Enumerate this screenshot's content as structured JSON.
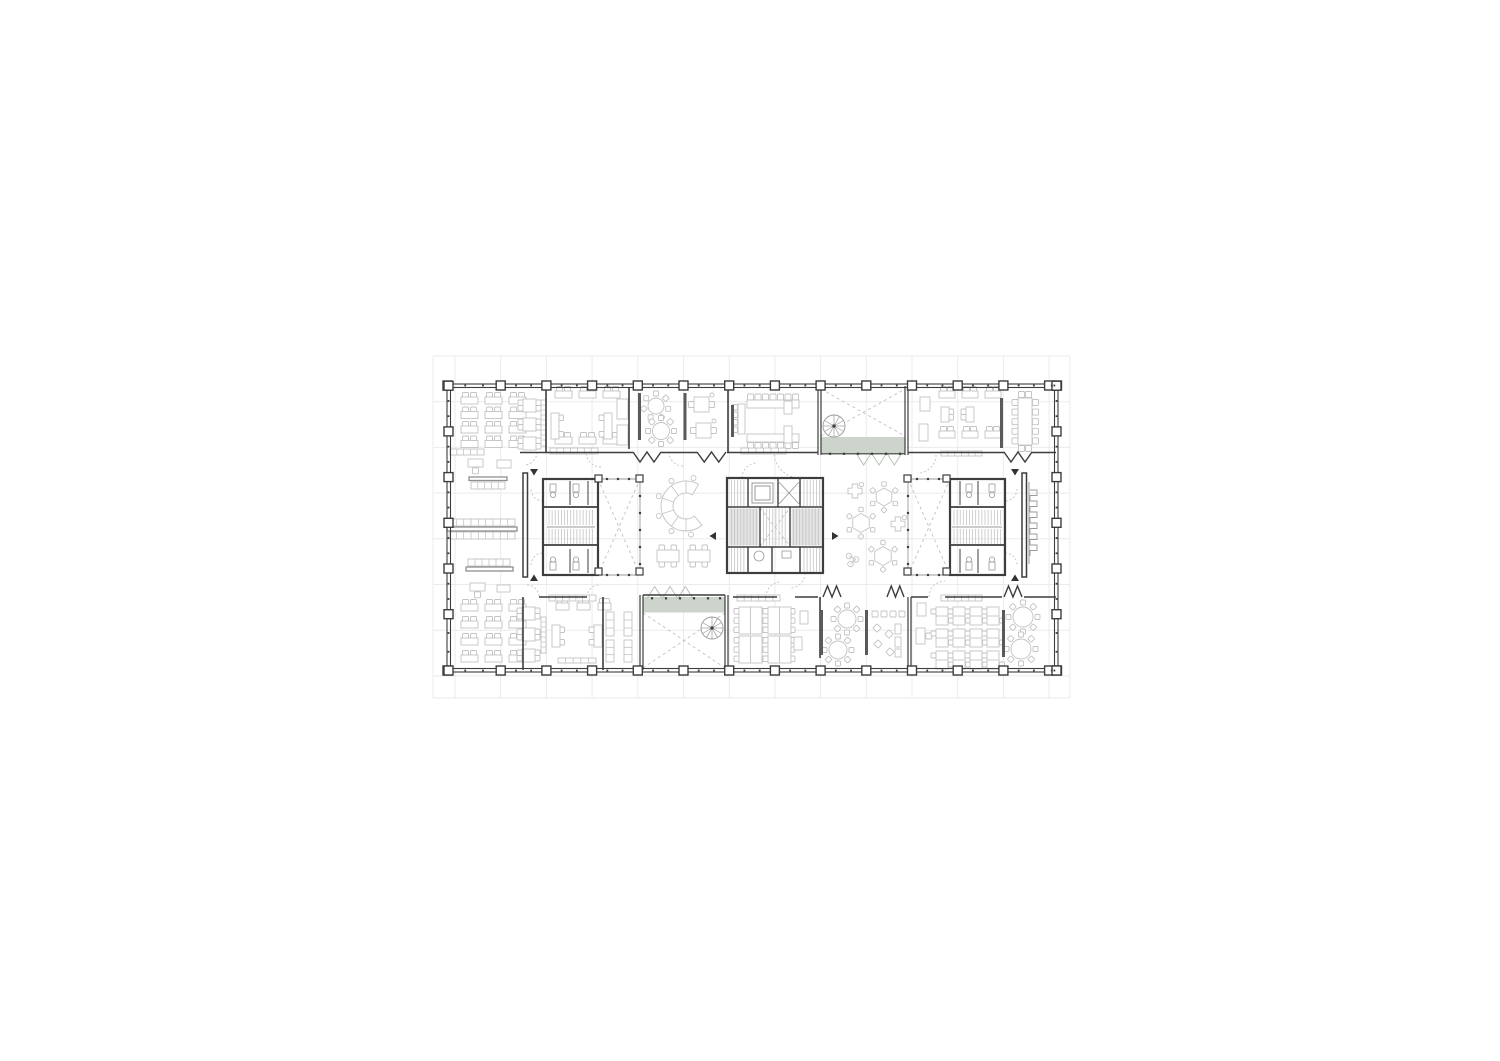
{
  "palette": {
    "bg": "#ffffff",
    "grid": "#ebebeb",
    "wall": "#3d3d3d",
    "wall_light": "#9a9a9a",
    "furniture": "#c3c3c3",
    "furniture_dark": "#8f8f8f",
    "dash": "#c2c2c2",
    "green": "#cdd4cb",
    "green_line": "#b6c2b5",
    "stair_fill": "#e4e4e4",
    "hatch": "#bcbcbc"
  },
  "canvas": {
    "w": 1500,
    "h": 1061
  },
  "grid": {
    "x0": 433,
    "y0": 356,
    "x1": 1070,
    "y1": 698,
    "vxs": [
      455,
      500.7,
      546.4,
      592.1,
      637.8,
      683.5,
      729.2,
      774.9,
      820.6,
      866.3,
      912,
      957.7,
      1003.4,
      1049.1
    ],
    "hys": [
      356,
      401.7,
      447.4,
      493.1,
      538.8,
      584.5,
      630.2,
      675.9
    ]
  },
  "building": {
    "x": 447,
    "y": 384,
    "w": 611,
    "h": 288
  },
  "columns": {
    "size": 9,
    "tick": 1.8,
    "top_xs": [
      447.5,
      500.7,
      546.4,
      592.1,
      637.8,
      683.5,
      729.2,
      774.9,
      820.6,
      866.3,
      912,
      957.7,
      1003.4,
      1049.1,
      1057
    ],
    "top_y": 385.5,
    "bottom_y": 670.5,
    "side_ys": [
      385.7,
      431.4,
      477.1,
      522.8,
      568.5,
      614.2,
      670.5
    ],
    "left_x": 448.5,
    "right_x": 1056.5
  },
  "walls": [
    [
      546,
      388,
      546,
      452,
      1.6
    ],
    [
      629,
      388,
      629,
      449,
      1.6
    ],
    [
      728,
      388,
      728,
      452,
      1.6
    ],
    [
      818,
      386,
      818,
      455,
      1.2
    ],
    [
      821,
      386,
      821,
      455,
      1.2
    ],
    [
      905,
      386,
      905,
      455,
      1.2
    ],
    [
      908,
      386,
      908,
      455,
      1.2
    ],
    [
      520,
      452.5,
      633,
      452.5,
      1.6
    ],
    [
      661,
      452.5,
      697,
      452.5,
      1.6
    ],
    [
      727,
      452.5,
      818,
      452.5,
      1.6
    ],
    [
      821,
      453.8,
      905,
      453.8,
      1.1
    ],
    [
      908,
      452.5,
      1004,
      452.5,
      1.6
    ],
    [
      1032,
      452.5,
      1056,
      452.5,
      1.6
    ],
    [
      543,
      507,
      598,
      507,
      1.8
    ],
    [
      543,
      545,
      598,
      545,
      1.8
    ],
    [
      570,
      481,
      570,
      505,
      1
    ],
    [
      570,
      549,
      570,
      573,
      1
    ],
    [
      588,
      481,
      588,
      505,
      1
    ],
    [
      588,
      549,
      588,
      573,
      1
    ],
    [
      727,
      507,
      823,
      507,
      1.6
    ],
    [
      727,
      547,
      823,
      547,
      1.6
    ],
    [
      748,
      478,
      748,
      507,
      1.4
    ],
    [
      778,
      478,
      778,
      507,
      1.4
    ],
    [
      800,
      478,
      800,
      507,
      1.4
    ],
    [
      748,
      547,
      748,
      573,
      1.4
    ],
    [
      772,
      547,
      772,
      573,
      1.4
    ],
    [
      800,
      547,
      800,
      573,
      1.4
    ],
    [
      760,
      507,
      760,
      547,
      1.4
    ],
    [
      790,
      507,
      790,
      547,
      1.4
    ],
    [
      950,
      507,
      1005,
      507,
      1.8
    ],
    [
      950,
      545,
      1005,
      545,
      1.8
    ],
    [
      978,
      481,
      978,
      505,
      1
    ],
    [
      978,
      549,
      978,
      573,
      1
    ],
    [
      960,
      481,
      960,
      505,
      1
    ],
    [
      960,
      549,
      960,
      573,
      1
    ],
    [
      523,
      597,
      523,
      670,
      1.6
    ],
    [
      603,
      597,
      603,
      670,
      1.6
    ],
    [
      539,
      597,
      587,
      597,
      1.6
    ],
    [
      640,
      595,
      640,
      670,
      1.2
    ],
    [
      643,
      595,
      643,
      670,
      1.2
    ],
    [
      725,
      595,
      725,
      670,
      1.2
    ],
    [
      728,
      595,
      728,
      670,
      1.2
    ],
    [
      643,
      595,
      725,
      595,
      1.4
    ],
    [
      733,
      597,
      777,
      597,
      1.6
    ],
    [
      795,
      597,
      818,
      597,
      1.6
    ],
    [
      820,
      597,
      820,
      658,
      1.6
    ],
    [
      908,
      597,
      908,
      670,
      1.2
    ],
    [
      911,
      597,
      911,
      670,
      1.2
    ],
    [
      911,
      597,
      928,
      597,
      1.6
    ],
    [
      945,
      597,
      1002,
      597,
      1.6
    ],
    [
      1024,
      597,
      1056,
      597,
      1.6
    ]
  ],
  "lite_walls": [
    [
      598,
      479,
      640,
      479
    ],
    [
      598,
      575,
      640,
      575
    ],
    [
      640,
      479,
      640,
      575
    ],
    [
      908,
      479,
      950,
      479
    ],
    [
      908,
      575,
      950,
      575
    ],
    [
      908,
      479,
      908,
      575
    ]
  ],
  "frames": [
    {
      "x": 543,
      "y": 479,
      "w": 55,
      "h": 96,
      "sw": 2.2
    },
    {
      "x": 727,
      "y": 478,
      "w": 96,
      "h": 95,
      "sw": 2.2
    },
    {
      "x": 950,
      "y": 479,
      "w": 55,
      "h": 96,
      "sw": 2.2
    },
    {
      "x": 523,
      "y": 473,
      "w": 4.5,
      "h": 104,
      "sw": 1.5
    },
    {
      "x": 1022,
      "y": 473,
      "w": 4.5,
      "h": 104,
      "sw": 1.5
    }
  ],
  "partition_bars": [
    [
      638,
      393,
      3,
      47
    ],
    [
      683.5,
      393,
      3,
      47
    ],
    [
      1000,
      398,
      3,
      50
    ],
    [
      731,
      405,
      3,
      32
    ],
    [
      820,
      610,
      3,
      45
    ],
    [
      865,
      610,
      3,
      45
    ],
    [
      1002,
      610,
      3,
      47
    ]
  ],
  "shelves": [
    [
      450,
      449,
      34,
      6,
      5
    ],
    [
      550,
      448,
      48,
      6,
      7
    ],
    [
      741,
      448,
      45,
      6,
      6
    ],
    [
      941,
      451,
      41,
      5,
      6
    ],
    [
      549,
      595,
      47,
      6,
      7
    ],
    [
      737,
      595,
      43,
      6,
      6
    ],
    [
      941,
      595,
      41,
      6,
      6
    ],
    [
      558,
      658,
      38,
      5,
      5
    ],
    [
      606,
      612,
      8,
      24,
      3
    ],
    [
      606,
      640,
      8,
      22,
      3
    ],
    [
      624,
      612,
      8,
      24,
      3
    ],
    [
      624,
      640,
      8,
      22,
      3
    ]
  ],
  "bars": [
    [
      469,
      477,
      38,
      3.5
    ],
    [
      447,
      527,
      70,
      4
    ],
    [
      466,
      567,
      47,
      4
    ]
  ],
  "bench_grids": [
    [
      471,
      482,
      34,
      7,
      5
    ],
    [
      449,
      519,
      66,
      7,
      9
    ],
    [
      449,
      532,
      66,
      7,
      9
    ],
    [
      468,
      559,
      42,
      7,
      6
    ]
  ],
  "green_strips": [
    {
      "x": 821.5,
      "y": 437,
      "w": 83.5,
      "h": 16.5,
      "zz": [
        856,
        902,
        453,
        -12
      ]
    },
    {
      "x": 643,
      "y": 597,
      "w": 82,
      "h": 15.5,
      "zz": [
        647,
        693,
        598.5,
        12
      ]
    }
  ],
  "stairs": [
    {
      "x": 547,
      "y": 510,
      "w": 48,
      "h": 15
    },
    {
      "x": 547,
      "y": 529,
      "w": 48,
      "h": 15
    },
    {
      "x": 952,
      "y": 510,
      "w": 50,
      "h": 15
    },
    {
      "x": 952,
      "y": 529,
      "w": 50,
      "h": 15
    },
    {
      "x": 729.5,
      "y": 480,
      "w": 17,
      "h": 26
    },
    {
      "x": 802,
      "y": 480,
      "w": 19.5,
      "h": 26
    },
    {
      "x": 729.5,
      "y": 548,
      "w": 17,
      "h": 24
    },
    {
      "x": 802,
      "y": 548,
      "w": 19.5,
      "h": 24
    },
    {
      "x": 729.5,
      "y": 508.5,
      "w": 29,
      "h": 37,
      "fill": true
    },
    {
      "x": 791.5,
      "y": 508.5,
      "w": 30,
      "h": 37,
      "fill": true
    },
    {
      "x": 761.5,
      "y": 508.5,
      "w": 27,
      "h": 37
    }
  ],
  "landings": [
    [
      547,
      527,
      595,
      527
    ],
    [
      952,
      527,
      1002,
      527
    ]
  ],
  "elevator": {
    "outer": [
      752,
      483,
      21,
      20
    ],
    "inner": [
      755,
      486,
      15,
      14
    ],
    "shaft": [
      778,
      481,
      22,
      24
    ]
  },
  "fixture_rects": [
    [
      550,
      484,
      6,
      8
    ],
    [
      573,
      484,
      6,
      8
    ],
    [
      550,
      562,
      6,
      8
    ],
    [
      573,
      562,
      6,
      8
    ],
    [
      966,
      484,
      6,
      8
    ],
    [
      989,
      484,
      6,
      8
    ],
    [
      966,
      562,
      6,
      8
    ],
    [
      989,
      562,
      6,
      8
    ],
    [
      782,
      551,
      9,
      7
    ]
  ],
  "fixture_circles": [
    [
      553,
      495,
      2.6
    ],
    [
      576,
      495,
      2.6
    ],
    [
      553,
      559.5,
      2.6
    ],
    [
      576,
      559.5,
      2.6
    ],
    [
      969,
      495,
      2.6
    ],
    [
      992,
      495,
      2.6
    ],
    [
      969,
      559.5,
      2.6
    ],
    [
      992,
      559.5,
      2.6
    ],
    [
      759,
      556,
      5
    ]
  ],
  "xcrosses": [
    [
      821,
      389,
      905,
      436
    ],
    [
      643,
      613,
      725,
      668
    ],
    [
      598,
      479,
      640,
      575
    ],
    [
      908,
      479,
      950,
      575
    ],
    [
      760,
      508,
      790,
      546
    ]
  ],
  "posts": [
    [
      595,
      475
    ],
    [
      636,
      475
    ],
    [
      595,
      568
    ],
    [
      636,
      568
    ],
    [
      904,
      475
    ],
    [
      904,
      568
    ],
    [
      943,
      475
    ],
    [
      943,
      568
    ]
  ],
  "dots": [
    {
      "y": 453.8,
      "xs": [
        830,
        844,
        858,
        872,
        886,
        900
      ]
    },
    {
      "y": 598.3,
      "xs": [
        652,
        666,
        680,
        694,
        708,
        720
      ]
    },
    {
      "y": 479,
      "xs": [
        607,
        618,
        629
      ]
    },
    {
      "y": 575,
      "xs": [
        607,
        618,
        629
      ]
    },
    {
      "x": 640,
      "ys": [
        496,
        513,
        530,
        547,
        564
      ]
    },
    {
      "y": 479,
      "xs": [
        917,
        928,
        939
      ]
    },
    {
      "y": 575,
      "xs": [
        917,
        928,
        939
      ]
    },
    {
      "x": 908,
      "ys": [
        496,
        513,
        530,
        547,
        564
      ]
    }
  ],
  "spirals": [
    [
      834,
      426,
      11
    ],
    [
      712,
      628,
      11
    ]
  ],
  "zigzags": [
    [
      633,
      661,
      452,
      -10
    ],
    [
      697,
      726,
      452,
      -10
    ],
    [
      1004,
      1032,
      452,
      -10
    ],
    [
      823,
      841,
      597,
      11
    ],
    [
      887,
      904,
      597,
      11
    ],
    [
      1004,
      1022,
      597,
      11
    ]
  ],
  "door_arcs": [
    [
      524,
      452,
      13,
      0,
      90
    ],
    [
      601,
      452,
      15,
      90,
      180
    ],
    [
      683,
      452,
      14,
      90,
      180
    ],
    [
      800,
      452,
      26,
      90,
      180
    ],
    [
      918,
      455,
      18,
      0,
      90
    ],
    [
      527,
      597,
      12,
      270,
      360
    ],
    [
      599,
      597,
      12,
      180,
      270
    ],
    [
      781,
      597,
      15,
      180,
      270
    ],
    [
      945,
      597,
      16,
      180,
      270
    ],
    [
      543,
      489,
      12,
      90,
      180
    ],
    [
      543,
      565,
      12,
      180,
      270
    ],
    [
      1005,
      489,
      12,
      0,
      90
    ],
    [
      1005,
      565,
      12,
      270,
      360
    ],
    [
      757,
      478,
      15,
      180,
      270
    ],
    [
      790,
      573,
      15,
      0,
      90
    ]
  ],
  "arrows": [
    {
      "d": "down",
      "x": 534,
      "y": 469
    },
    {
      "d": "up",
      "x": 534,
      "y": 581
    },
    {
      "d": "down",
      "x": 1015,
      "y": 469
    },
    {
      "d": "up",
      "x": 1015,
      "y": 581
    },
    {
      "d": "left",
      "x": 716,
      "y": 536
    },
    {
      "d": "right",
      "x": 832,
      "y": 536
    }
  ],
  "scallop": {
    "x": 1029,
    "y0": 490,
    "y1": 556,
    "teeth": 6,
    "depth": 7
  },
  "c_counter": {
    "cx": 686,
    "cy": 506,
    "ro": 25,
    "ri": 13,
    "a0": 50,
    "a1": 300,
    "stools": [
      80,
      120,
      160,
      200,
      240,
      285
    ]
  },
  "furniture": [
    {
      "t": "desk2",
      "x": 461,
      "y": 397,
      "w": 17,
      "cols": 3,
      "rows": 4,
      "dx": 24,
      "dy": 14.5
    },
    {
      "t": "table4v",
      "x": 523,
      "y": 399,
      "s": 13,
      "rows": 3,
      "dy": 19
    },
    {
      "t": "rack",
      "x": 541,
      "y": 400,
      "w": 5,
      "h": 46
    },
    {
      "t": "tdesk",
      "x": 468,
      "y": 459
    },
    {
      "t": "rect",
      "x": 497,
      "y": 460,
      "w": 14,
      "h": 8
    },
    {
      "t": "desk2",
      "x": 555,
      "y": 391,
      "w": 17,
      "cols": 3,
      "rows": 1,
      "dx": 24,
      "dy": 0
    },
    {
      "t": "desk2",
      "x": 555,
      "y": 437,
      "w": 17,
      "cols": 3,
      "rows": 1,
      "dx": 24,
      "dy": 0
    },
    {
      "t": "vdesk",
      "x": 551,
      "y": 413,
      "h": 26,
      "side": "right"
    },
    {
      "t": "vdesk",
      "x": 604,
      "y": 413,
      "h": 26,
      "side": "left"
    },
    {
      "t": "rect",
      "x": 617,
      "y": 399,
      "w": 11,
      "h": 20
    },
    {
      "t": "rect",
      "x": 617,
      "y": 425,
      "w": 11,
      "h": 20
    },
    {
      "t": "round",
      "cx": 656,
      "cy": 406,
      "r": 8,
      "n": 7
    },
    {
      "t": "round",
      "cx": 661,
      "cy": 431,
      "r": 8.5,
      "n": 8
    },
    {
      "t": "table4",
      "x": 694,
      "y": 397,
      "s": 15
    },
    {
      "t": "table4",
      "x": 696,
      "y": 423,
      "s": 15
    },
    {
      "t": "vtable",
      "x": 738,
      "y": 404,
      "w": 7,
      "h": 30
    },
    {
      "t": "htable",
      "x": 747,
      "y": 400,
      "w": 52,
      "h": 8,
      "side": "top",
      "n": 7
    },
    {
      "t": "htable",
      "x": 747,
      "y": 434,
      "w": 52,
      "h": 8,
      "side": "bottom",
      "n": 7
    },
    {
      "t": "rect",
      "x": 784,
      "y": 401,
      "w": 8,
      "h": 13
    },
    {
      "t": "rect",
      "x": 784,
      "y": 426,
      "w": 8,
      "h": 17
    },
    {
      "t": "rect",
      "x": 920,
      "y": 397,
      "w": 10,
      "h": 14
    },
    {
      "t": "rect",
      "x": 919,
      "y": 424,
      "w": 9,
      "h": 17
    },
    {
      "t": "desk2",
      "x": 939,
      "y": 391,
      "w": 16,
      "cols": 3,
      "rows": 1,
      "dx": 23,
      "dy": 0
    },
    {
      "t": "vdesk",
      "x": 941,
      "y": 407,
      "h": 15,
      "side": "right"
    },
    {
      "t": "vdesk",
      "x": 966,
      "y": 407,
      "h": 15,
      "side": "left"
    },
    {
      "t": "desk2",
      "x": 939,
      "y": 431,
      "w": 16,
      "cols": 3,
      "rows": 1,
      "dx": 23,
      "dy": 0
    },
    {
      "t": "confv",
      "x": 1018,
      "y": 398,
      "w": 14,
      "h": 47
    },
    {
      "t": "t4h",
      "x": 657,
      "y": 550
    },
    {
      "t": "t4h",
      "x": 688,
      "y": 550
    },
    {
      "t": "cross",
      "cx": 855,
      "cy": 491
    },
    {
      "t": "hex",
      "cx": 884,
      "cy": 497,
      "r": 9
    },
    {
      "t": "hex",
      "cx": 861,
      "cy": 523,
      "r": 9.5
    },
    {
      "t": "cross",
      "cx": 898,
      "cy": 524
    },
    {
      "t": "hex",
      "cx": 883,
      "cy": 556,
      "r": 9.5
    },
    {
      "t": "tric",
      "cx": 849,
      "cy": 556
    },
    {
      "t": "tdesk",
      "x": 470,
      "y": 583
    },
    {
      "t": "rect",
      "x": 497,
      "y": 585,
      "w": 13,
      "h": 7
    },
    {
      "t": "desk2",
      "x": 461,
      "y": 604,
      "w": 17,
      "cols": 3,
      "rows": 4,
      "dx": 24,
      "dy": 17
    },
    {
      "t": "table4v",
      "x": 522,
      "y": 607,
      "s": 13,
      "rows": 3,
      "dy": 21
    },
    {
      "t": "rack",
      "x": 541,
      "y": 617,
      "w": 5,
      "h": 36
    },
    {
      "t": "desk2",
      "x": 556,
      "y": 603,
      "w": 13,
      "cols": 3,
      "rows": 1,
      "dx": 21,
      "dy": 0
    },
    {
      "t": "vdesk",
      "x": 552,
      "y": 625,
      "h": 22,
      "side": "right"
    },
    {
      "t": "vdesk",
      "x": 594,
      "y": 625,
      "h": 22,
      "side": "left"
    },
    {
      "t": "cluster",
      "x": 739,
      "y": 607,
      "cols": 2,
      "rows": 2,
      "dx": 29,
      "dy": 29
    },
    {
      "t": "rect",
      "x": 800,
      "y": 611,
      "w": 8,
      "h": 13
    },
    {
      "t": "rect",
      "x": 794,
      "y": 637,
      "w": 8,
      "h": 13
    },
    {
      "t": "round",
      "cx": 847,
      "cy": 619,
      "r": 9,
      "n": 8
    },
    {
      "t": "round",
      "cx": 838,
      "cy": 650,
      "r": 9,
      "n": 8
    },
    {
      "t": "sq",
      "x": 872,
      "y": 611,
      "s": 6,
      "cols": 4,
      "dx": 9
    },
    {
      "t": "dia",
      "cx": 877,
      "cy": 628
    },
    {
      "t": "dia",
      "cx": 889,
      "cy": 634
    },
    {
      "t": "dia",
      "cx": 878,
      "cy": 644
    },
    {
      "t": "dia",
      "cx": 890,
      "cy": 652
    },
    {
      "t": "rect",
      "x": 895,
      "y": 624,
      "w": 6,
      "h": 10
    },
    {
      "t": "rect",
      "x": 895,
      "y": 637,
      "w": 6,
      "h": 10
    },
    {
      "t": "rect",
      "x": 895,
      "y": 649,
      "w": 6,
      "h": 8
    },
    {
      "t": "rect",
      "x": 917,
      "y": 603,
      "w": 9,
      "h": 13
    },
    {
      "t": "tdeskv",
      "x": 916,
      "y": 628
    },
    {
      "t": "pairv",
      "x": 936,
      "y": 607,
      "cols": 4,
      "rows": 3,
      "dx": 17,
      "dy": 22
    },
    {
      "t": "round",
      "cx": 1023,
      "cy": 617,
      "r": 10,
      "n": 8
    },
    {
      "t": "round",
      "cx": 1021,
      "cy": 649,
      "r": 10,
      "n": 8
    }
  ]
}
